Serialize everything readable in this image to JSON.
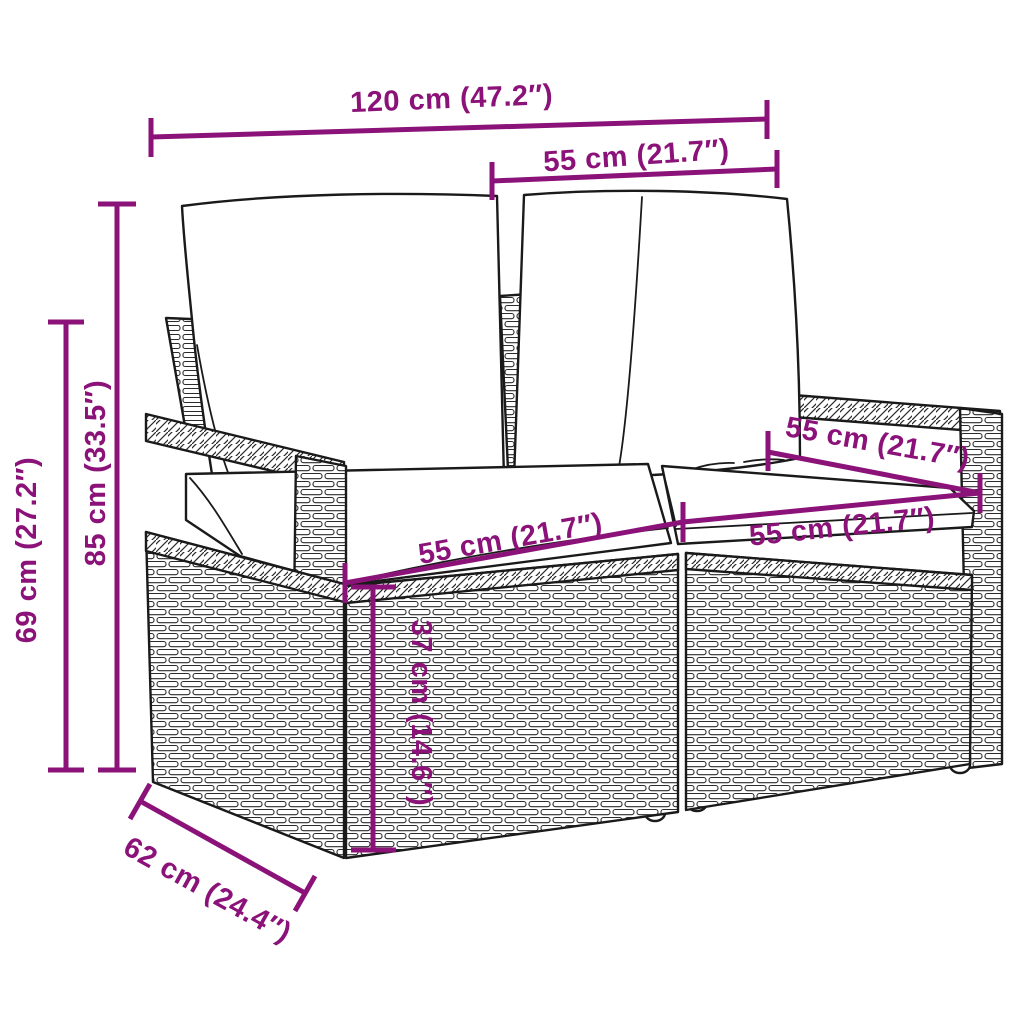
{
  "diagram": {
    "type": "product-dimension-diagram",
    "subject": "2-seater poly rattan garden sofa with back and seat cushions",
    "accent_color": "#8B1278",
    "line_color": "#1a1a1a",
    "background_color": "#ffffff",
    "dimensions": {
      "overall_width": {
        "label": "120 cm (47.2″)"
      },
      "backrest_width": {
        "label": "55 cm (21.7″)"
      },
      "seat_depth": {
        "label": "55 cm (21.7″)"
      },
      "seat_width_left": {
        "label": "55 cm (21.7″)"
      },
      "seat_width_right": {
        "label": "55 cm (21.7″)"
      },
      "total_height": {
        "label": "85 cm (33.5″)"
      },
      "armrest_height": {
        "label": "69 cm (27.2″)"
      },
      "seat_height": {
        "label": "37 cm (14.6″)"
      },
      "depth": {
        "label": "62 cm (24.4″)"
      }
    }
  }
}
